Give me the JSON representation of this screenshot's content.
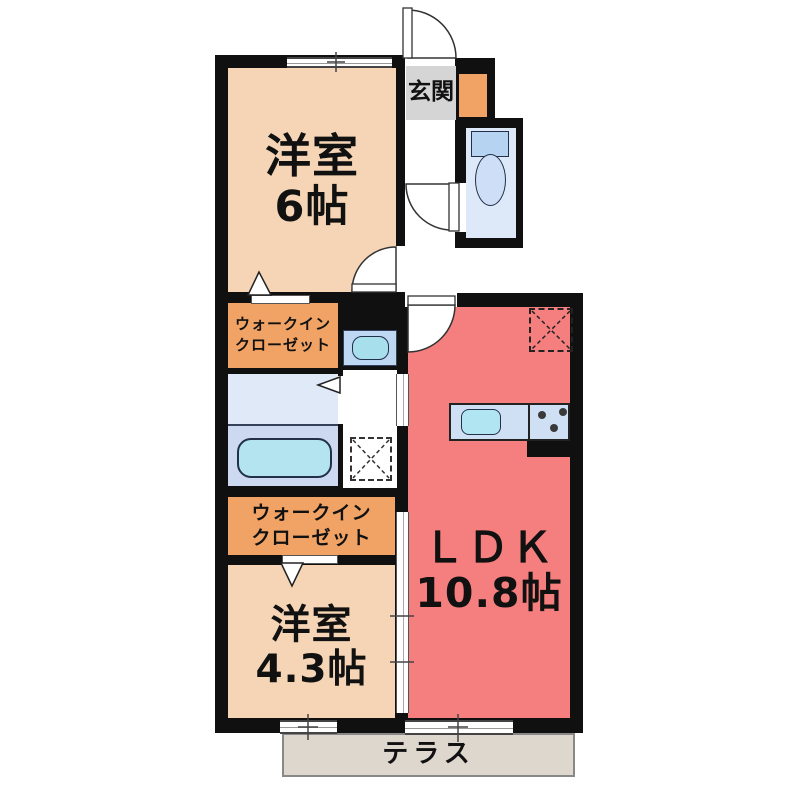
{
  "plan": {
    "type": "apartment-floorplan",
    "rooms": {
      "bedroom_6": {
        "label_line1": "洋室",
        "label_line2": "6帖"
      },
      "entrance": {
        "label": "玄関"
      },
      "walkin_closet_upper": {
        "label_line1": "ウォークイン",
        "label_line2": "クローゼット"
      },
      "walkin_closet_lower": {
        "label_line1": "ウォークイン",
        "label_line2": "クローゼット"
      },
      "bedroom_43": {
        "label_line1": "洋室",
        "label_line2": "4.3帖"
      },
      "ldk": {
        "label_line1": "ＬＤＫ",
        "label_line2": "10.8帖"
      },
      "terrace": {
        "label": "テラス"
      }
    },
    "fixtures": {
      "toilet": "toilet-with-tank",
      "bathtub": "bathtub",
      "washbasin": "washbasin-vanity",
      "kitchen_sink": "kitchen-sink",
      "stove": "stove-3-burner",
      "refrigerator_space": "refrigerator-space-dashed-x",
      "laundry_space": "washing-machine-space-dashed-x",
      "entrance_door": "swing-door",
      "toilet_door": "swing-door",
      "bedroom6_door": "swing-door",
      "ldk_door": "swing-door",
      "shoe_cabinet": "shoe-cabinet"
    },
    "colors": {
      "wall": "#101010",
      "bedroom_floor": "#f5d5b5",
      "closet_orange": "#f0a365",
      "ldk_salmon": "#f57f7f",
      "entrance_gray": "#d5d5d5",
      "toilet_floor": "#dde9f8",
      "washroom_floor": "#dfe9f8",
      "bath_floor": "#ccd9f1",
      "tub_cyan": "#b4e4f0",
      "counter_blue": "#cfe0f5",
      "sink_cyan": "#b2e5f2",
      "terrace_gray": "#ded7ce"
    }
  }
}
